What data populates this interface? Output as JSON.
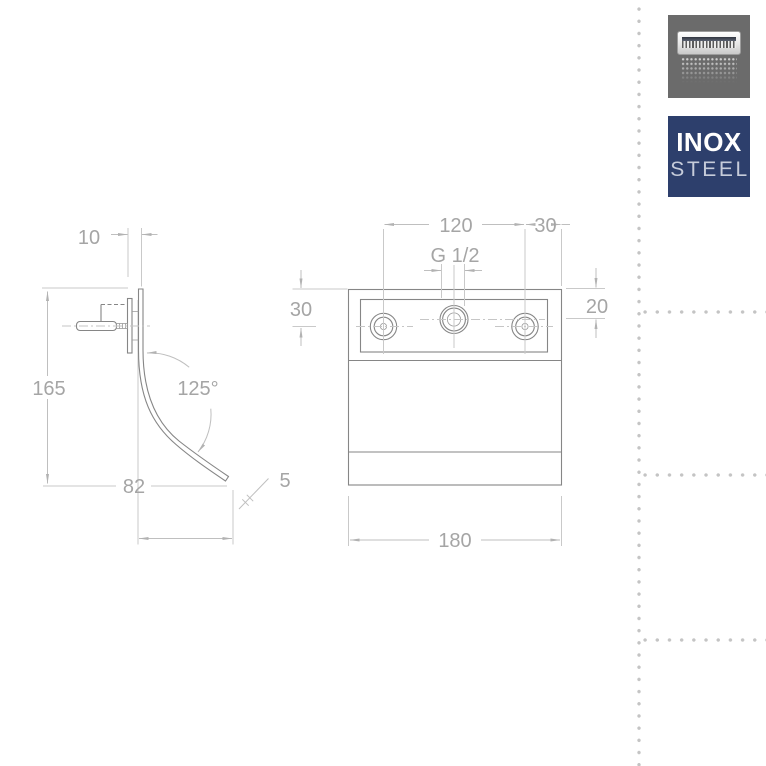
{
  "colors": {
    "object_line": "#868686",
    "dimension_line": "#bfbfbf",
    "dimension_text": "#a5a5a5",
    "center_line": "#c6c6c6",
    "dotted_guides": "#c4c4c4",
    "badge_gray": "#6b6b6b",
    "badge_navy": "#2d3f6c",
    "steel_text": "#c6ccda"
  },
  "badges": {
    "shower_icon": "waterfall-shower-head-icon",
    "inox": {
      "line1": "INOX",
      "line2": "STEEL"
    }
  },
  "drawing": {
    "side_view": {
      "name": "waterfall spout side profile",
      "dims": {
        "offset": "10",
        "height": "165",
        "reach": "82",
        "angle": "125°",
        "thickness": "5"
      }
    },
    "front_view": {
      "name": "wall plate front view",
      "dims": {
        "hole_spacing": "120",
        "edge_offset": "30",
        "thread": "G 1/2",
        "top_to_holes": "30",
        "top_to_center": "20",
        "width": "180"
      }
    }
  }
}
